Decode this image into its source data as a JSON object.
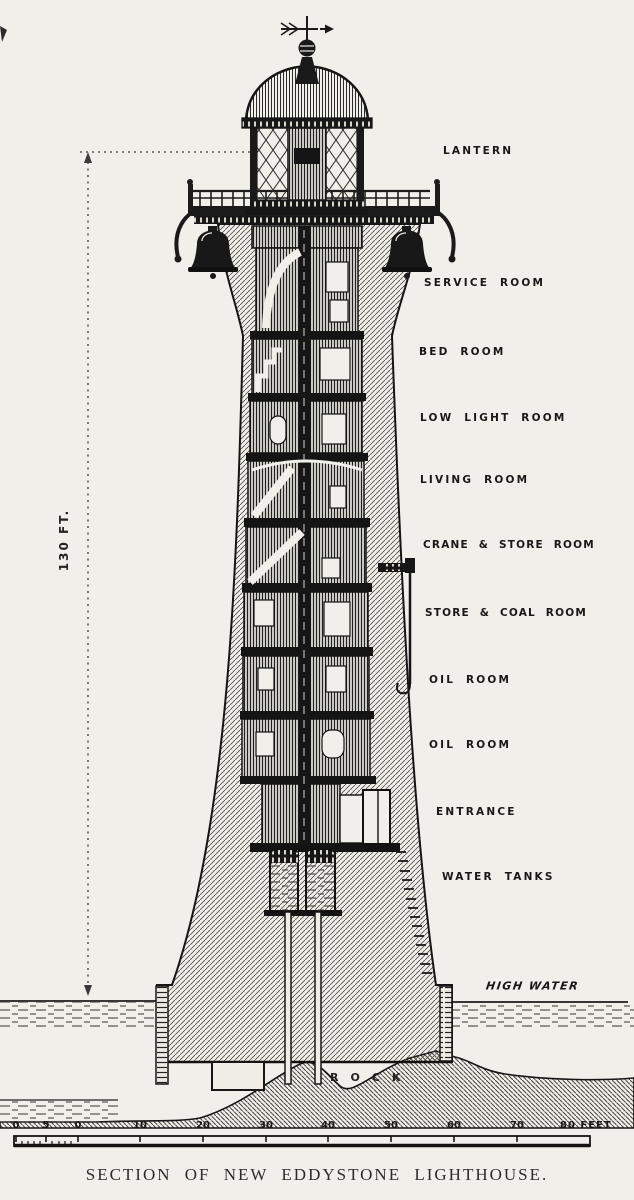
{
  "caption": "SECTION OF NEW EDDYSTONE LIGHTHOUSE.",
  "height_dimension": "130 FT.",
  "room_labels": [
    "LANTERN",
    "SERVICE ROOM",
    "BED ROOM",
    "LOW LIGHT ROOM",
    "LIVING ROOM",
    "CRANE & STORE ROOM",
    "STORE & COAL ROOM",
    "OIL ROOM",
    "OIL ROOM",
    "ENTRANCE",
    "WATER TANKS"
  ],
  "water_label": "HIGH WATER",
  "rock_label": "ROCK",
  "scale": {
    "tick_labels": [
      "0",
      "5",
      "0",
      "10",
      "20",
      "30",
      "40",
      "50",
      "60",
      "70"
    ],
    "end_label": "80 FEET"
  },
  "colors": {
    "paper": "#f1efe9",
    "ink": "#1a1a1a"
  }
}
